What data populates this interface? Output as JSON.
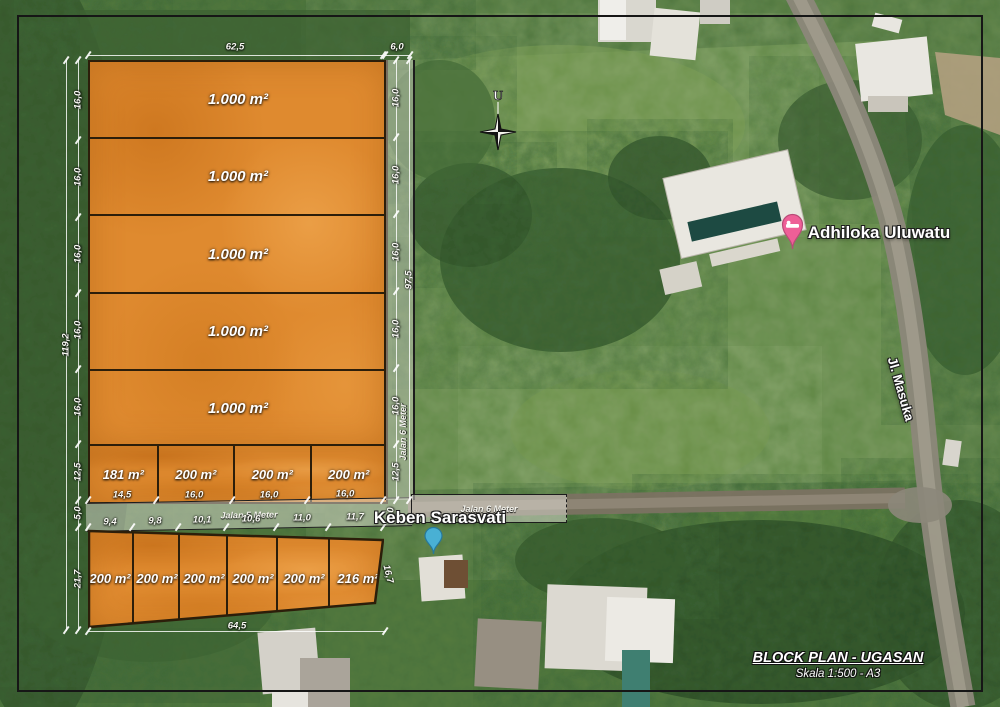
{
  "plan": {
    "parcels_large": [
      "1.000 m²",
      "1.000 m²",
      "1.000 m²",
      "1.000 m²",
      "1.000 m²"
    ],
    "parcels_middle": [
      "181 m²",
      "200 m²",
      "200 m²",
      "200 m²"
    ],
    "parcels_bottom": [
      "200 m²",
      "200 m²",
      "200 m²",
      "200 m²",
      "200 m²",
      "216 m²"
    ]
  },
  "roads": {
    "jalan5": "Jalan 5 Meter",
    "jalan6_vertical": "Jalan 6 Meter",
    "jalan6_horizontal": "Jalan 6 Meter"
  },
  "dims": {
    "top_width": "62,5",
    "top_road": "6,0",
    "left_rows": [
      "16,0",
      "16,0",
      "16,0",
      "16,0",
      "16,0"
    ],
    "left_middle": "12,5",
    "left_road": "5,0",
    "left_bottom": "21,7",
    "left_total": "119,2",
    "right_rows": [
      "16,0",
      "16,0",
      "16,0",
      "16,0",
      "16,0"
    ],
    "right_middle": "12,5",
    "right_road": "5,0",
    "right_total": "97,5",
    "right_slant": "16,7",
    "mid_upper": [
      "14,5",
      "16,0",
      "16,0",
      "16,0"
    ],
    "mid_lower": [
      "9,4",
      "9,8",
      "10,1",
      "10,6",
      "11,0",
      "11,7"
    ],
    "bottom_total": "64,5"
  },
  "map": {
    "compass_north": "U",
    "poi_adhiloka": "Adhiloka Uluwatu",
    "poi_keben": "Keben Sarasvati",
    "road_masuka": "Jl. Masuka"
  },
  "title_block": {
    "title": "BLOCK PLAN - UGASAN",
    "scale": "Skala 1:500 - A3"
  },
  "colors": {
    "parcel_orange": "#df8a2f",
    "pin_pink": "#ee5f97",
    "pin_teal": "#49b0d4",
    "frame": "#161616"
  }
}
